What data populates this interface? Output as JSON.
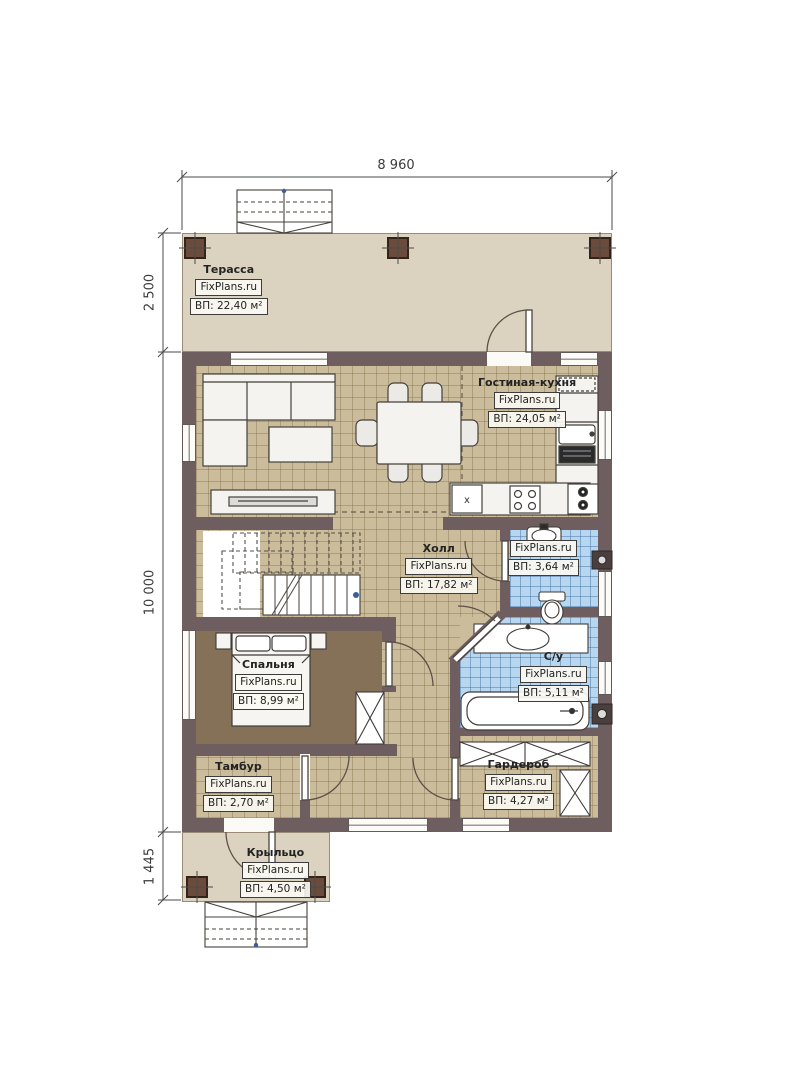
{
  "brand": "FixPlans.ru",
  "dimensions": {
    "top_width": "8 960",
    "terrace_depth": "2 500",
    "house_depth": "10 000",
    "porch_depth": "1 445"
  },
  "rooms": {
    "terrace": {
      "name": "Терасса",
      "brand": "FixPlans.ru",
      "area": "ВП: 22,40 м²"
    },
    "living_kitchen": {
      "name": "Гостиная-кухня",
      "brand": "FixPlans.ru",
      "area": "ВП: 24,05 м²"
    },
    "hall": {
      "name": "Холл",
      "brand": "FixPlans.ru",
      "area": "ВП: 17,82 м²"
    },
    "wc": {
      "brand": "FixPlans.ru",
      "area": "ВП: 3,64 м²"
    },
    "bathroom": {
      "name": "С/у",
      "brand": "FixPlans.ru",
      "area": "ВП: 5,11 м²"
    },
    "bedroom": {
      "name": "Спальня",
      "brand": "FixPlans.ru",
      "area": "ВП: 8,99 м²"
    },
    "vestibule": {
      "name": "Тамбур",
      "brand": "FixPlans.ru",
      "area": "ВП: 2,70 м²"
    },
    "wardrobe": {
      "name": "Гардероб",
      "brand": "FixPlans.ru",
      "area": "ВП: 4,27 м²"
    },
    "porch": {
      "name": "Крыльцо",
      "brand": "FixPlans.ru",
      "area": "ВП: 4,50 м²"
    }
  },
  "symbols": {
    "appliance_marker": "x"
  },
  "colors": {
    "wall": "#6e5e5f",
    "terrace_floor": "#dcd2c0",
    "tile_floor": "#cbbd9c",
    "bedroom_floor": "#857157",
    "bath_floor": "#b7d7f1",
    "column": "#6b4c3c",
    "stair_marker": "#3b5f9e"
  }
}
